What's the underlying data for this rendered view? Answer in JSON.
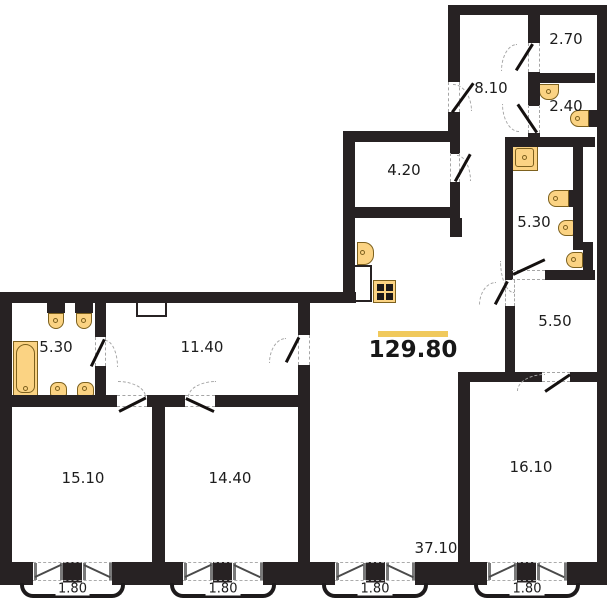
{
  "plan": {
    "type": "apartment-floor-plan",
    "total_area": "129.80",
    "palette": {
      "wall": "#272223",
      "fixture_fill": "#fbd383",
      "fixture_border": "#7d611e",
      "accent_underline": "#f0c95c",
      "text": "#1d1d1d",
      "dashed_lines": "#a5a5a5"
    }
  },
  "rooms": [
    {
      "id": "room-2-70",
      "area": "2.70"
    },
    {
      "id": "room-8-10",
      "area": "8.10"
    },
    {
      "id": "room-2-40",
      "area": "2.40"
    },
    {
      "id": "room-4-20",
      "area": "4.20"
    },
    {
      "id": "room-5-30-right",
      "area": "5.30"
    },
    {
      "id": "room-5-50",
      "area": "5.50"
    },
    {
      "id": "room-11-40",
      "area": "11.40"
    },
    {
      "id": "room-5-30-left",
      "area": "5.30"
    },
    {
      "id": "room-15-10",
      "area": "15.10"
    },
    {
      "id": "room-14-40",
      "area": "14.40"
    },
    {
      "id": "room-16-10",
      "area": "16.10"
    },
    {
      "id": "room-37-10",
      "area": "37.10"
    }
  ],
  "window_labels": [
    "1.80",
    "1.80",
    "1.80",
    "1.80"
  ],
  "fixtures": [
    "bathtub",
    "toilet",
    "toilet",
    "washbasin",
    "washbasin",
    "kitchen-sink",
    "stove",
    "vent-shaft",
    "shower",
    "washbasin",
    "toilet",
    "bidet",
    "washbasin",
    "washbasin"
  ]
}
